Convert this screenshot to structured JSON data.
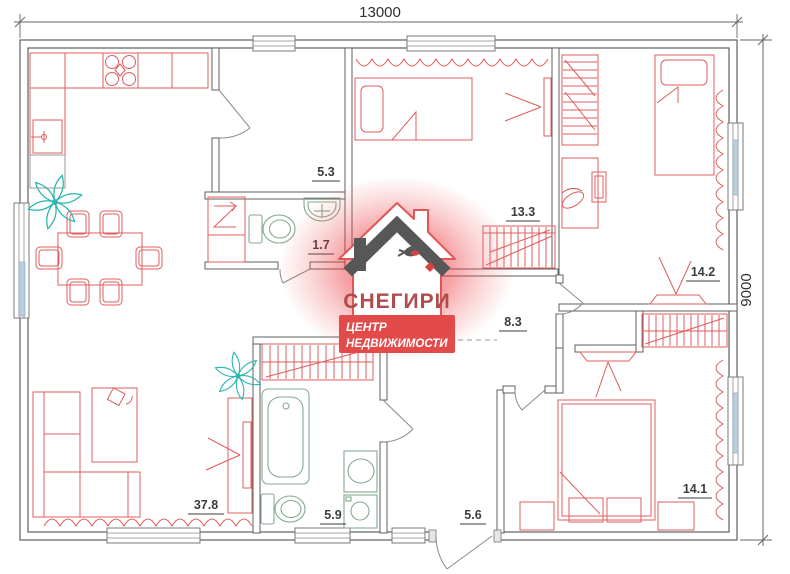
{
  "dimensions": {
    "width_label": "13000",
    "height_label": "9000"
  },
  "rooms": [
    {
      "name": "hall",
      "area": "5.3"
    },
    {
      "name": "wc",
      "area": "1.7"
    },
    {
      "name": "bedroom-top-middle",
      "area": "13.3"
    },
    {
      "name": "corridor",
      "area": "8.3"
    },
    {
      "name": "bedroom-top-right",
      "area": "14.2"
    },
    {
      "name": "living-kitchen",
      "area": "37.8"
    },
    {
      "name": "bathroom",
      "area": "5.9"
    },
    {
      "name": "entrance-hall",
      "area": "5.6"
    },
    {
      "name": "bedroom-bottom-right",
      "area": "14.1"
    }
  ],
  "watermark": {
    "brand": "СНЕГИРИ",
    "tagline_line1": "ЦЕНТР",
    "tagline_line2": "НЕДВИЖИМОСТИ"
  },
  "colors": {
    "furniture": "#e05c5c",
    "sanitary": "#84a98f",
    "plant": "#2ab5ad",
    "walls": "#5f5f5f",
    "logo_red": "#e34b4b",
    "logo_text": "#b04c4c"
  }
}
